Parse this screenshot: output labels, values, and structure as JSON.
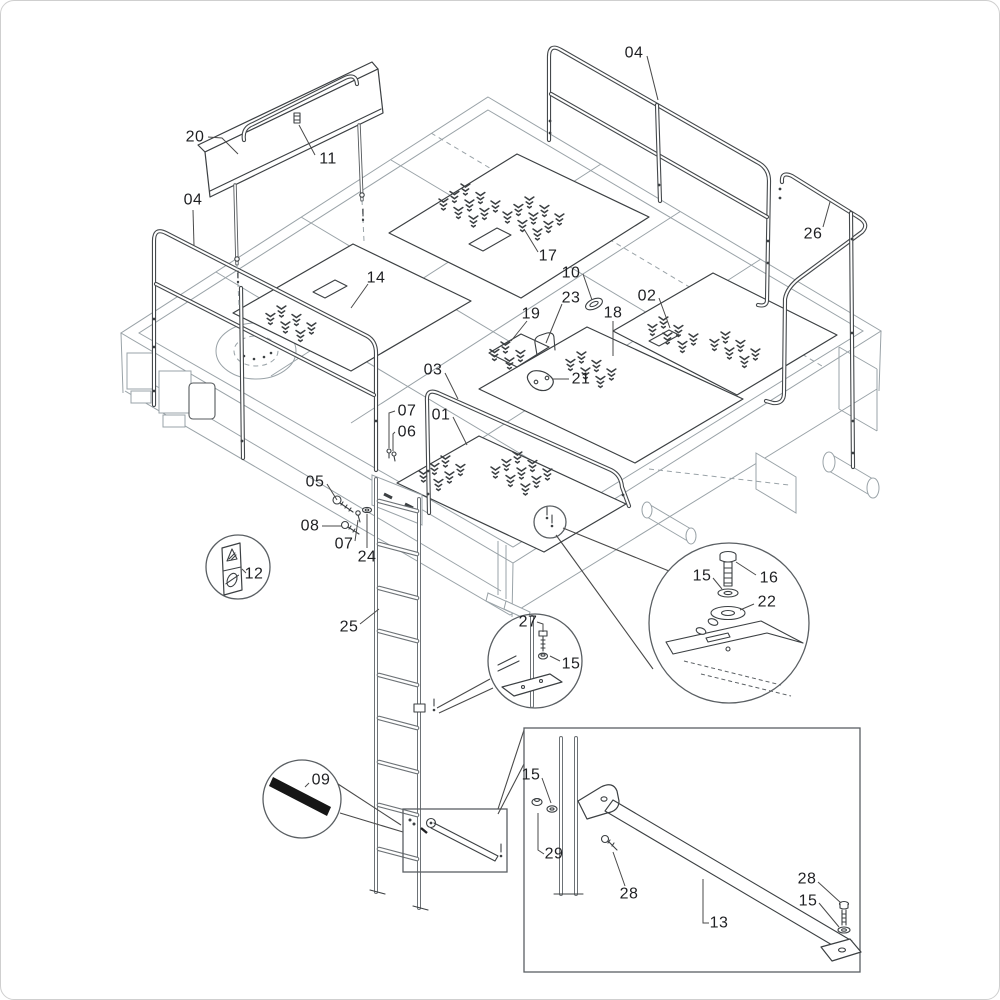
{
  "canvas": {
    "width": 1000,
    "height": 1000,
    "background": "#ffffff",
    "border_color": "#cfcfcf"
  },
  "diagram": {
    "type": "exploded-parts-diagram",
    "subject": "platform-frame-with-guard-rails-and-ladder",
    "frame_line_color": "#9aa3a8",
    "part_line_color": "#3c4043",
    "label_color": "#1f2023",
    "leader_color": "#4a4a4a",
    "grip_tape_color": "#161616"
  },
  "callouts": [
    {
      "part": "20",
      "x": 194,
      "y": 136,
      "leader": [
        [
          207,
          136
        ],
        [
          221,
          137
        ],
        [
          237,
          153
        ]
      ]
    },
    {
      "part": "11",
      "x": 327,
      "y": 158,
      "leader": [
        [
          314,
          154
        ],
        [
          298,
          124
        ]
      ]
    },
    {
      "part": "04",
      "x": 192,
      "y": 199,
      "leader": [
        [
          192,
          209
        ],
        [
          193,
          245
        ]
      ]
    },
    {
      "part": "04",
      "x": 633,
      "y": 52,
      "leader": [
        [
          646,
          55
        ],
        [
          657,
          99
        ]
      ]
    },
    {
      "part": "26",
      "x": 812,
      "y": 233,
      "leader": [
        [
          822,
          226
        ],
        [
          829,
          201
        ]
      ]
    },
    {
      "part": "17",
      "x": 547,
      "y": 255,
      "leader": [
        [
          537,
          251
        ],
        [
          523,
          228
        ]
      ]
    },
    {
      "part": "10",
      "x": 570,
      "y": 272,
      "leader": [
        [
          582,
          273
        ],
        [
          591,
          299
        ]
      ]
    },
    {
      "part": "23",
      "x": 570,
      "y": 297,
      "leader": [
        [
          561,
          303
        ],
        [
          545,
          342
        ]
      ]
    },
    {
      "part": "02",
      "x": 646,
      "y": 295,
      "leader": [
        [
          658,
          297
        ],
        [
          669,
          327
        ]
      ]
    },
    {
      "part": "19",
      "x": 530,
      "y": 313,
      "leader": [
        [
          526,
          320
        ],
        [
          510,
          340
        ]
      ]
    },
    {
      "part": "18",
      "x": 612,
      "y": 312,
      "leader": [
        [
          612,
          320
        ],
        [
          612,
          355
        ]
      ]
    },
    {
      "part": "14",
      "x": 375,
      "y": 277,
      "leader": [
        [
          367,
          283
        ],
        [
          350,
          307
        ]
      ]
    },
    {
      "part": "21",
      "x": 580,
      "y": 378,
      "leader": [
        [
          568,
          378
        ],
        [
          551,
          378
        ]
      ]
    },
    {
      "part": "03",
      "x": 432,
      "y": 369,
      "leader": [
        [
          444,
          372
        ],
        [
          457,
          398
        ]
      ]
    },
    {
      "part": "01",
      "x": 440,
      "y": 414,
      "leader": [
        [
          452,
          416
        ],
        [
          466,
          444
        ]
      ]
    },
    {
      "part": "07",
      "x": 406,
      "y": 410,
      "leader": [
        [
          394,
          410
        ],
        [
          388,
          412
        ],
        [
          388,
          447
        ]
      ]
    },
    {
      "part": "06",
      "x": 406,
      "y": 431,
      "leader": [
        [
          394,
          431
        ],
        [
          392,
          433
        ],
        [
          392,
          450
        ]
      ]
    },
    {
      "part": "05",
      "x": 314,
      "y": 481,
      "leader": [
        [
          326,
          483
        ],
        [
          336,
          499
        ]
      ]
    },
    {
      "part": "08",
      "x": 309,
      "y": 525,
      "leader": [
        [
          321,
          525
        ],
        [
          341,
          525
        ]
      ]
    },
    {
      "part": "07",
      "x": 343,
      "y": 543,
      "leader": [
        [
          354,
          540
        ],
        [
          357,
          519
        ]
      ]
    },
    {
      "part": "24",
      "x": 366,
      "y": 556,
      "leader": [
        [
          366,
          547
        ],
        [
          366,
          513
        ]
      ]
    },
    {
      "part": "12",
      "x": 253,
      "y": 573,
      "leader": [
        [
          245,
          572
        ],
        [
          241,
          568
        ]
      ]
    },
    {
      "part": "25",
      "x": 348,
      "y": 626,
      "leader": [
        [
          359,
          623
        ],
        [
          378,
          608
        ]
      ]
    },
    {
      "part": "27",
      "x": 527,
      "y": 621,
      "leader": [
        [
          536,
          621
        ],
        [
          542,
          623
        ],
        [
          542,
          631
        ]
      ]
    },
    {
      "part": "15",
      "x": 570,
      "y": 663,
      "leader": [
        [
          559,
          660
        ],
        [
          549,
          655
        ]
      ]
    },
    {
      "part": "15",
      "x": 701,
      "y": 575,
      "leader": [
        [
          712,
          577
        ],
        [
          721,
          588
        ]
      ]
    },
    {
      "part": "16",
      "x": 768,
      "y": 577,
      "leader": [
        [
          755,
          574
        ],
        [
          735,
          561
        ]
      ]
    },
    {
      "part": "22",
      "x": 766,
      "y": 601,
      "leader": [
        [
          753,
          603
        ],
        [
          739,
          609
        ]
      ]
    },
    {
      "part": "09",
      "x": 320,
      "y": 779,
      "leader": [
        [
          308,
          782
        ],
        [
          304,
          786
        ]
      ]
    },
    {
      "part": "15",
      "x": 530,
      "y": 774,
      "leader": [
        [
          541,
          777
        ],
        [
          550,
          802
        ]
      ]
    },
    {
      "part": "29",
      "x": 553,
      "y": 853,
      "leader": [
        [
          543,
          853
        ],
        [
          537,
          849
        ],
        [
          537,
          812
        ]
      ]
    },
    {
      "part": "28",
      "x": 628,
      "y": 893,
      "leader": [
        [
          624,
          885
        ],
        [
          612,
          851
        ]
      ]
    },
    {
      "part": "13",
      "x": 718,
      "y": 922,
      "leader": [
        [
          708,
          922
        ],
        [
          702,
          922
        ],
        [
          702,
          878
        ]
      ]
    },
    {
      "part": "28",
      "x": 806,
      "y": 878,
      "leader": [
        [
          817,
          881
        ],
        [
          840,
          902
        ]
      ]
    },
    {
      "part": "15",
      "x": 807,
      "y": 900,
      "leader": [
        [
          818,
          902
        ],
        [
          838,
          926
        ]
      ]
    }
  ],
  "detail_views": [
    {
      "name": "warning-decal-circle",
      "shape": "circle",
      "parts": [
        "12"
      ]
    },
    {
      "name": "grip-tape-circle",
      "shape": "circle",
      "parts": [
        "09"
      ]
    },
    {
      "name": "ladder-bracket-circle",
      "shape": "circle",
      "parts": [
        "27",
        "15"
      ]
    },
    {
      "name": "mount-hardware-circle",
      "shape": "circle",
      "parts": [
        "15",
        "16",
        "22"
      ]
    },
    {
      "name": "support-rod-box",
      "shape": "rectangle",
      "parts": [
        "15",
        "29",
        "28",
        "13",
        "28",
        "15"
      ]
    },
    {
      "name": "rod-location-box",
      "shape": "rectangle",
      "parts": []
    }
  ]
}
